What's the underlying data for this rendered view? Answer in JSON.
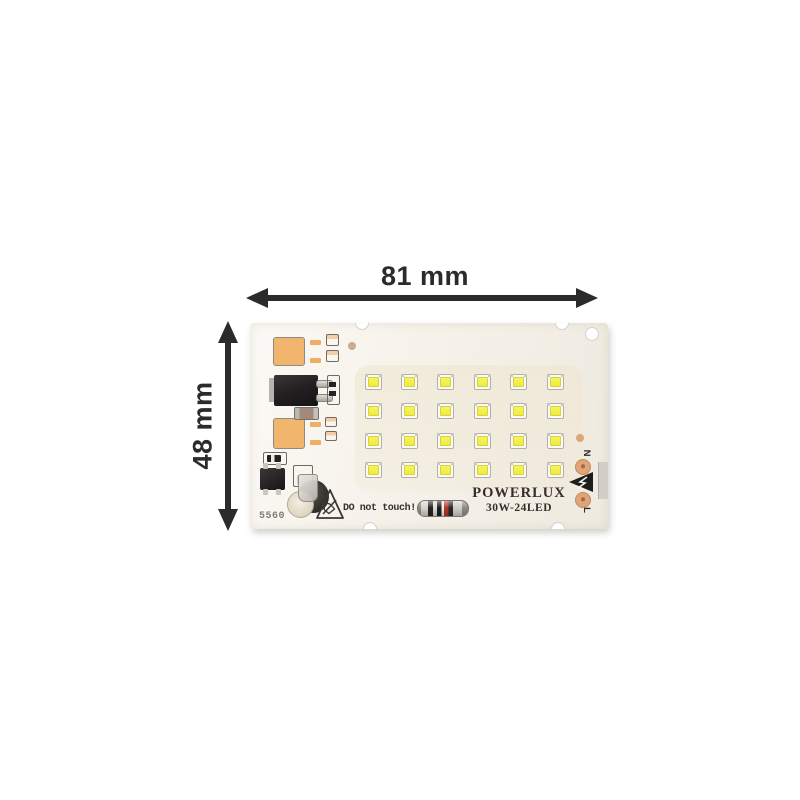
{
  "dimensions": {
    "width_label": "81 mm",
    "height_label": "48 mm"
  },
  "pcb": {
    "silkscreen": {
      "brand": "POWERLUX",
      "model": "30W-24LED",
      "warning": "DO not touch!",
      "serial": "5560",
      "live_label": "L",
      "neutral_label": "N"
    },
    "led_grid": {
      "rows": 4,
      "cols": 6,
      "count": 24
    },
    "icons": [
      "esd-warning-icon",
      "brand-triangle-icon"
    ],
    "colors": {
      "board": "#f6f2ea",
      "led_die": "#f0ee44",
      "pad_orange": "#f2b56d",
      "terminal_orange": "#e2a377",
      "component_black": "#232122",
      "annotation": "#2b2b2b"
    }
  }
}
